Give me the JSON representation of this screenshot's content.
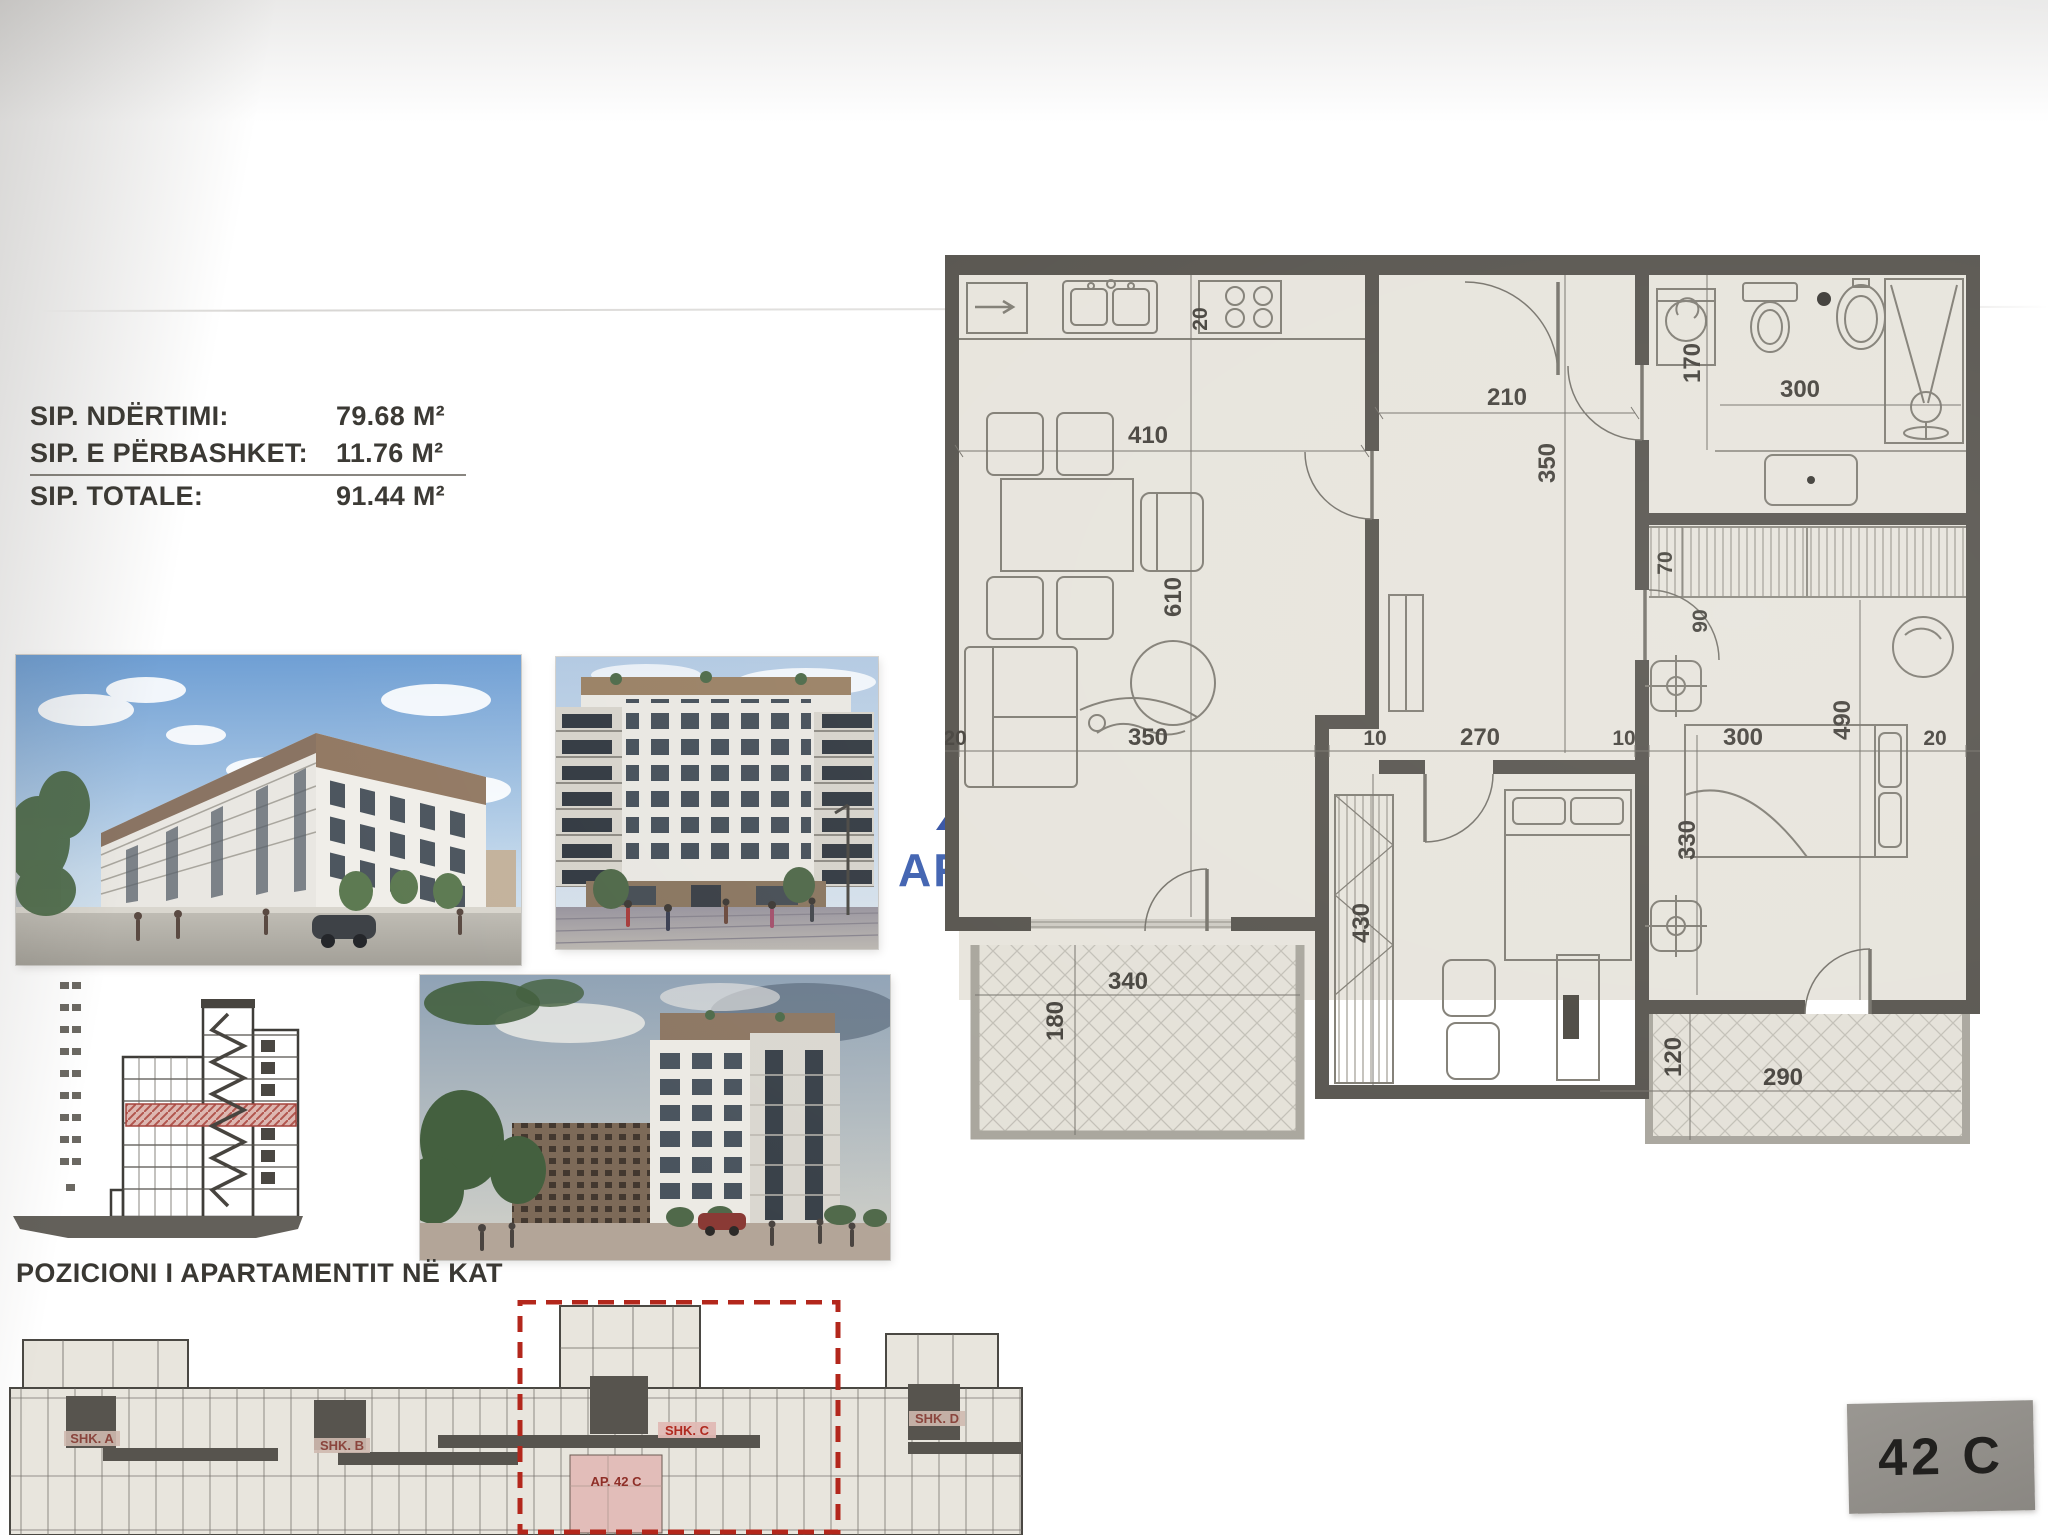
{
  "area_info": {
    "rows": [
      {
        "label": "SIP. NDËRTIMI:",
        "value": "79.68 M²"
      },
      {
        "label": "SIP. E PËRBASHKET:",
        "value": "11.76 M²"
      },
      {
        "label": "SIP. TOTALE:",
        "value": "91.44 M²"
      }
    ]
  },
  "logo": {
    "brand_primary": "ARKA",
    "brand_secondary": "HOME",
    "triangle_color": "#3552a3",
    "boat_color": "#ee8e3a",
    "text_primary_color": "#3f61b0",
    "text_secondary_color": "#8fa7d6"
  },
  "floorplan": {
    "dimensions": [
      {
        "t": "410"
      },
      {
        "t": "20"
      },
      {
        "t": "210"
      },
      {
        "t": "300"
      },
      {
        "t": "170"
      },
      {
        "t": "350"
      },
      {
        "t": "610"
      },
      {
        "t": "70"
      },
      {
        "t": "90"
      },
      {
        "t": "490"
      },
      {
        "t": "20"
      },
      {
        "t": "350"
      },
      {
        "t": "10"
      },
      {
        "t": "270"
      },
      {
        "t": "10"
      },
      {
        "t": "300"
      },
      {
        "t": "20"
      },
      {
        "t": "330"
      },
      {
        "t": "430"
      },
      {
        "t": "340"
      },
      {
        "t": "180"
      },
      {
        "t": "120"
      },
      {
        "t": "290"
      }
    ]
  },
  "position_section": {
    "title": "POZICIONI I APARTAMENTIT NË KAT",
    "cores": [
      {
        "label": "SHK. A"
      },
      {
        "label": "SHK. B"
      },
      {
        "label": "SHK. C"
      },
      {
        "label": "SHK. D"
      }
    ],
    "apartment_label": "AP. 42 C",
    "highlight_color": "#b3271c",
    "apartment_fill": "#e2bdb9"
  },
  "badge": {
    "label": "42 C"
  }
}
